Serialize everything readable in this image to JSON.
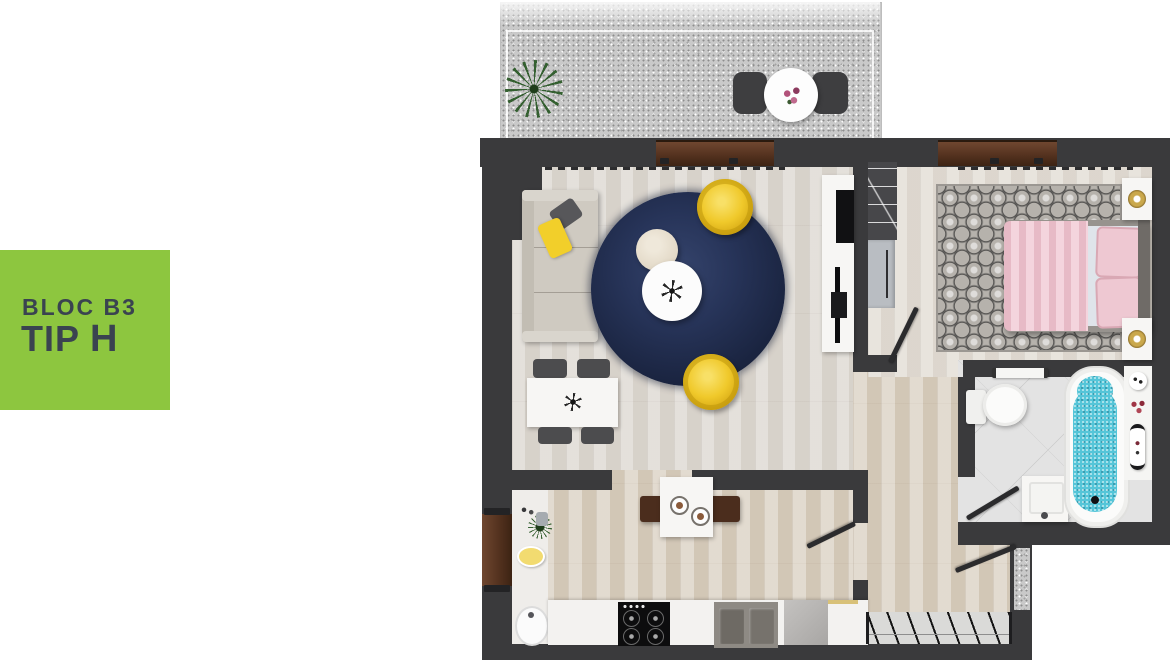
{
  "label": {
    "line1": "BLOC B3",
    "line2_word": "TIP",
    "line2_letter": "H"
  },
  "colors": {
    "accent_green": "#8DC63F",
    "label_text": "#3A4350",
    "wall_dark": "#3A3A3C",
    "window_brown": "#5E3B28",
    "rug_navy": "#1F2A47",
    "armchair_yellow": "#F0C92B",
    "sofa_beige": "#CFCAC1",
    "bed_pink": "#ECC3CD",
    "bathtub_cyan": "#55C5D8",
    "floor_living": "#DDD8D1",
    "floor_kitchen_hall": "#D9CFC0",
    "floor_bedroom": "#E2DCD4",
    "floor_bathroom": "#E3E3E3",
    "balcony_granite": "#C9C9C9"
  },
  "icons": {
    "balcony_plant": "starburst-plant",
    "kitchen_plant": "starburst-plant-small",
    "coffee_table_decor": "pinwheel",
    "dining_table_centerpiece": "starburst-dark"
  }
}
